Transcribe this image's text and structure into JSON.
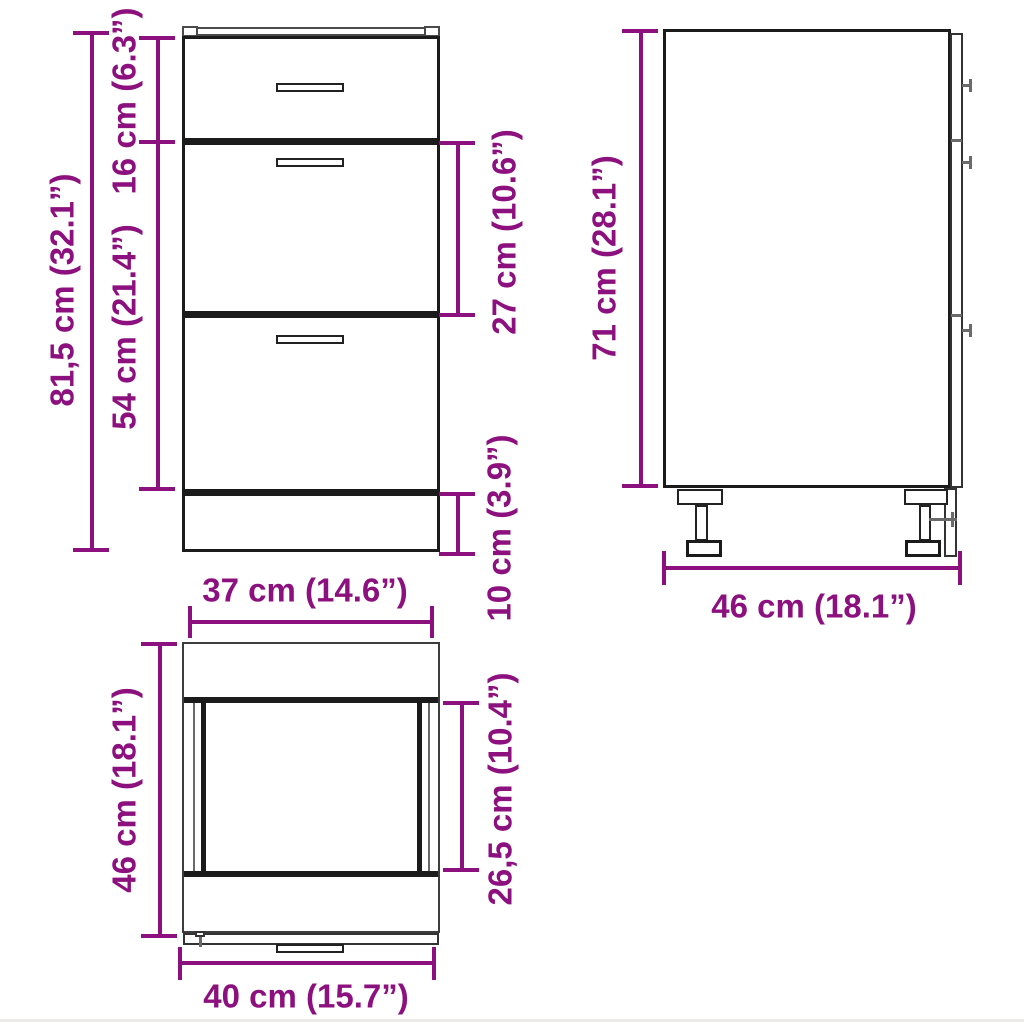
{
  "colors": {
    "dimension": "#8C107E",
    "outline": "#1b1b1b",
    "outline_gray": "#4a4a4a"
  },
  "front": {
    "total_height": "81,5 cm (32.1”)",
    "top_drawer_height": "16 cm (6.3”)",
    "lower_section_height": "54 cm (21.4”)",
    "middle_drawer_height": "27 cm (10.6”)",
    "plinth_height": "10 cm (3.9”)",
    "width": "37 cm (14.6”)"
  },
  "side": {
    "height": "71 cm (28.1”)",
    "depth": "46 cm (18.1”)"
  },
  "top": {
    "depth": "46 cm (18.1”)",
    "drawer_inner_depth": "26,5 cm (10.4”)",
    "width": "40 cm (15.7”)"
  }
}
